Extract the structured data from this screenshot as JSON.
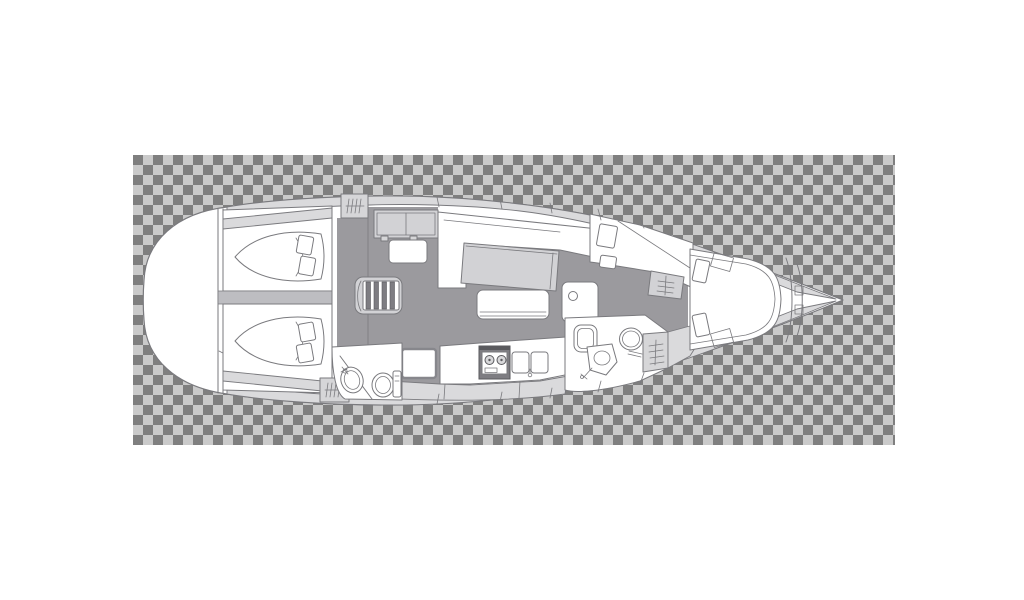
{
  "canvas": {
    "width": 1024,
    "height": 600
  },
  "colors": {
    "page_bg": "#ffffff",
    "checker_dark": "#7f7f7f",
    "checker_light": "#cacaca",
    "outline": "#7a7a7e",
    "outline_dark": "#5a5a5e",
    "hull": "#ffffff",
    "deck": "#dadadc",
    "furniture": "#d2d2d5",
    "locker": "#d6d6d8",
    "sole": "#9b9a9e",
    "divider": "#bdbdc1",
    "stove": "#7e7d82",
    "burner": "#d8d8da"
  },
  "transparency_grid": {
    "x": 133,
    "y": 155,
    "width": 762,
    "height": 290,
    "tile_size": 10,
    "first_tile": "dark"
  },
  "drawing": {
    "type": "sailboat-interior-layout-plan",
    "view": "top-down",
    "orientation": "bow-right-stern-left",
    "rooms": [
      {
        "id": "stern-lazarette",
        "label": "Stern / lazarette",
        "fixtures": []
      },
      {
        "id": "aft-cabin-port",
        "label": "Aft cabin (port)",
        "fixtures": [
          "double-berth",
          "pillows",
          "hull-shelf"
        ]
      },
      {
        "id": "aft-cabin-starboard",
        "label": "Aft cabin (starboard)",
        "fixtures": [
          "double-berth",
          "pillows",
          "hull-shelf"
        ]
      },
      {
        "id": "companionway",
        "label": "Companionway",
        "fixtures": [
          "steps",
          "hanging-locker-port",
          "hanging-locker-starboard",
          "sideboard",
          "seat"
        ]
      },
      {
        "id": "salon",
        "label": "Salon",
        "fixtures": [
          "settee",
          "dining-table",
          "bench-seat",
          "nav-seat",
          "mast-post"
        ]
      },
      {
        "id": "galley",
        "label": "Galley",
        "fixtures": [
          "refrigerator",
          "stove",
          "double-sink",
          "counter",
          "cabinets"
        ]
      },
      {
        "id": "aft-head",
        "label": "Aft head (bathroom)",
        "fixtures": [
          "washbasin",
          "toilet",
          "partition"
        ]
      },
      {
        "id": "forward-head",
        "label": "Forward head (bathroom)",
        "fixtures": [
          "shower",
          "washbasin",
          "toilet",
          "hanging-locker"
        ]
      },
      {
        "id": "forward-cabin",
        "label": "Forward cabin",
        "fixtures": [
          "v-berth",
          "pillows",
          "seat-cushions",
          "wardrobe-shelves",
          "deck-hatches"
        ]
      },
      {
        "id": "bow-locker",
        "label": "Bow anchor locker",
        "fixtures": [
          "chain-locker-bulkheads"
        ]
      }
    ]
  }
}
